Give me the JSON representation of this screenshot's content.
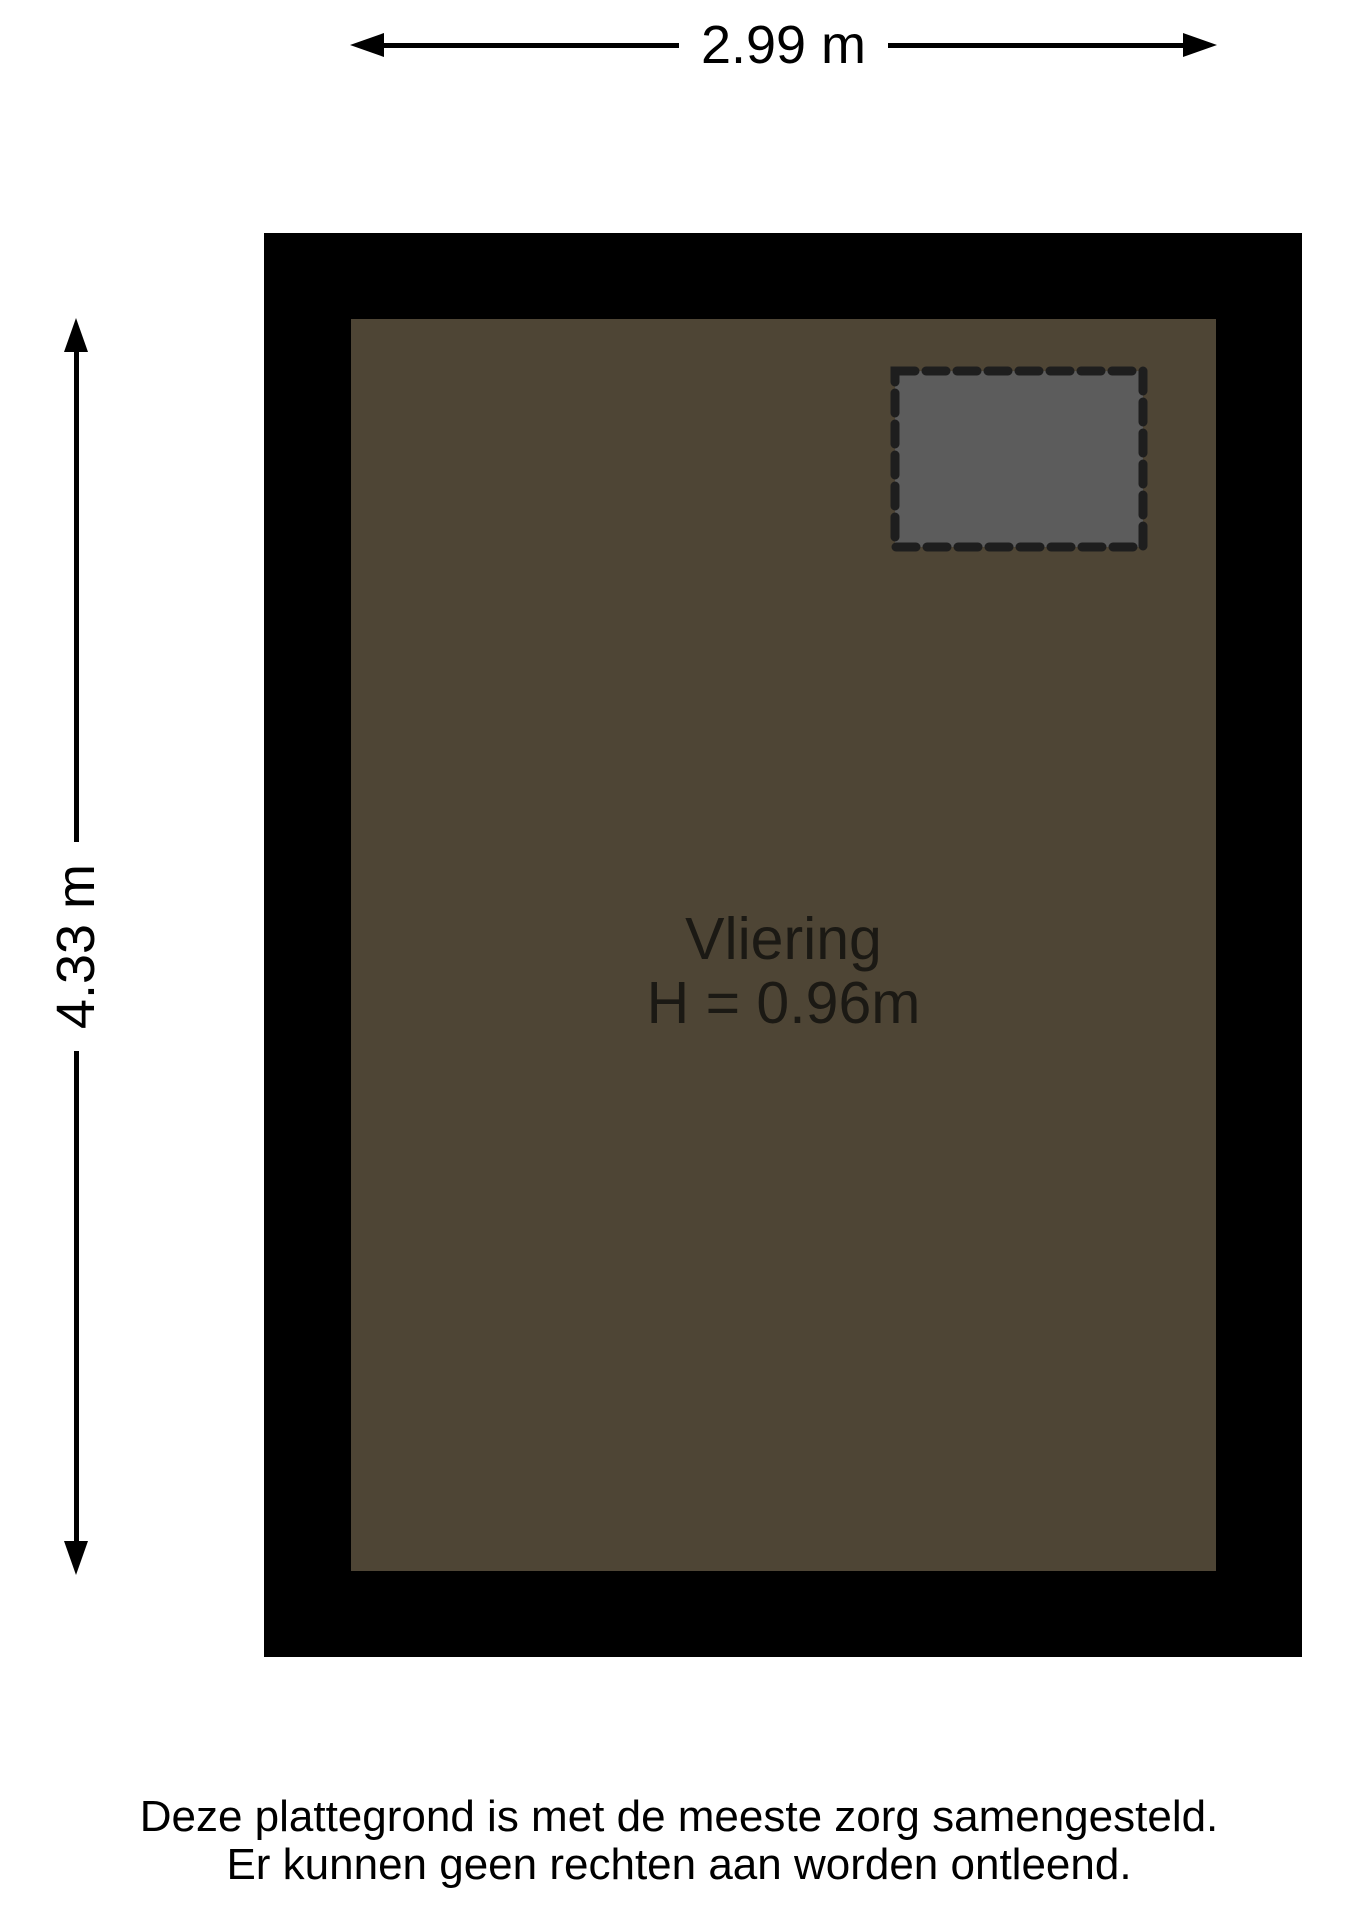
{
  "floorplan": {
    "room": {
      "name": "Vliering",
      "height": "H = 0.96m"
    },
    "dimensions": {
      "width": "2.99 m",
      "depth": "4.33 m"
    },
    "disclaimer": [
      "Deze plattegrond is met de meeste zorg samengesteld.",
      "Er kunnen geen rechten aan worden ontleend."
    ],
    "colors": {
      "background": "#ffffff",
      "wall": "#000000",
      "floor": "#4e4535",
      "hatch_fill": "#5c5c5c",
      "hatch_border": "#1e1e1e",
      "dimension_line": "#000000",
      "room_text": "#1b1914",
      "disclaimer_text": "#000000"
    }
  }
}
